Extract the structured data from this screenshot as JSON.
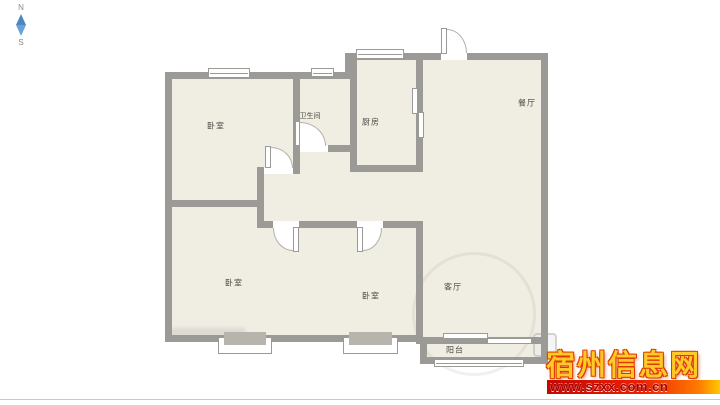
{
  "compass": {
    "north": "N",
    "south": "S"
  },
  "rooms": {
    "bedroom_top_left": "卧室",
    "bathroom": "卫生间",
    "kitchen": "厨房",
    "dining": "餐厅",
    "bedroom_bottom_left": "卧室",
    "bedroom_bottom_middle": "卧室",
    "living": "客厅",
    "balcony": "阳台"
  },
  "watermark": {
    "site_name": "宿州信息网",
    "url": "www.szxx.com.cn"
  },
  "colors": {
    "wall": "#9b9a96",
    "floor": "#f0ede3",
    "watermark_gold": "#ffc928",
    "watermark_red": "#e03a00",
    "url_text": "#aa0000",
    "compass_blue_top": "#4e86c0",
    "compass_blue_bottom": "#6aa2d8"
  }
}
